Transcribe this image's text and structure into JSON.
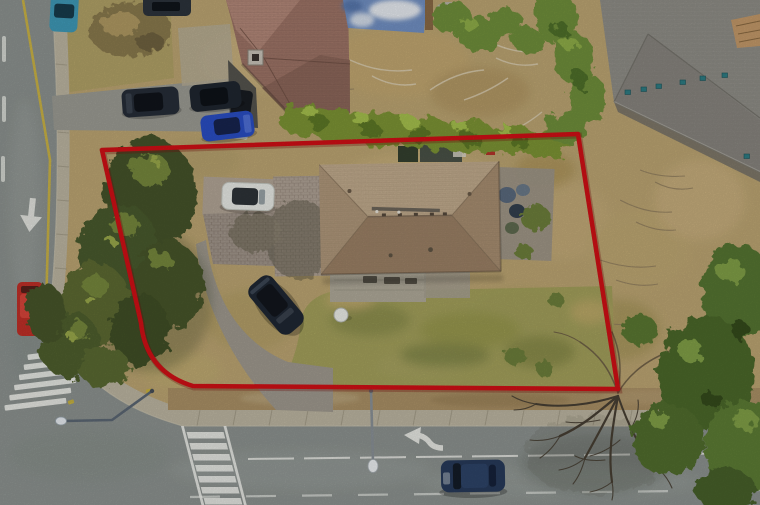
{
  "scene": {
    "title": "Top-down aerial drone photo of a corner residential lot outlined with a red property-boundary overlay",
    "view": "overhead aerial photograph",
    "boundary": {
      "color": "#d11016",
      "stroke_width": 4.5,
      "shape": "four-sided lot outline with rounded bottom-left corner",
      "corners": {
        "top_left": [
          102,
          150
        ],
        "top_right": [
          578,
          134
        ],
        "bottom_right": [
          618,
          389
        ],
        "bottom_edge_left_end": [
          193,
          386
        ],
        "left_edge_bottom_end": [
          141,
          323
        ]
      }
    },
    "colors": {
      "asphalt": "#8d9390",
      "sidewalk": "#bdb6a2",
      "verge_dirt": "#ab9166",
      "scrub_grass": "#bda673",
      "front_lawn": "#a2a05c",
      "hedge_green": "#7d9434",
      "conifer_dark": "#44532a",
      "canopy_green": "#4c682c",
      "subject_roof_light": "#c3ad8f",
      "subject_roof_dark": "#9c8166",
      "neighbor_roof": "#a07668",
      "big_roof_gray": "#92908a",
      "lane_yellow": "#d2b83e",
      "marking_white": "#f2f3ee",
      "paver_driveway": "#a79a8e"
    },
    "structures": {
      "subject_house": "large hip-roof bungalow centered in the outlined lot",
      "subject_patio": "concrete patio on south side of subject house",
      "satellite_dish": "small white dish south-west of patio",
      "neighbor_house": "clay-tile hip roof house, top left",
      "neighbor_chimney": "square chimney on neighbor roof",
      "big_gray_building": "large grey-shingled roof with teal vents, top right",
      "blue_tarp": "blue tarp with snow patches, top centre",
      "shed_items": "dark sheds / stored items behind hedge north of subject house"
    },
    "vehicles": {
      "white_car": {
        "color": "#e9ebe7",
        "location": "paver pad beside subject house"
      },
      "black_suv": {
        "color": "#1f2733",
        "location": "curved driveway of subject lot"
      },
      "neighbor_suv_1": {
        "color": "#262d38",
        "location": "neighbor driveway, left vehicle"
      },
      "neighbor_suv_2": {
        "color": "#1f2630",
        "location": "neighbor driveway, right vehicle"
      },
      "neighbor_blue_car": {
        "color": "#2a4ec4",
        "location": "neighbor driveway, lower vehicle"
      },
      "street_teal_car": {
        "color": "#3f9ab8",
        "location": "left road, top edge"
      },
      "street_dark_car_top": {
        "color": "#2c333c",
        "location": "top edge of frame"
      },
      "red_truck": {
        "color": "#c03028",
        "location": "left road, behind evergreen trees"
      },
      "road_blue_car": {
        "color": "#273a5a",
        "location": "bottom road, travelling lane"
      }
    },
    "road_markings": {
      "yellow_centre_line": "yellow line on left vertical road",
      "left_road_arrow": "white straight-ahead arrow on left road",
      "zebra_crosswalk": "zebra crosswalk across left road at intersection",
      "ladder_crosswalk": "ladder crosswalk across bottom road",
      "left_turn_arrow": "white left-turn arrow, bottom road",
      "lane_dashes": "white lane lines on bottom road"
    },
    "street_furniture": {
      "streetlight_sw": "bent streetlight arm over intersection, lamp at left",
      "streetlight_s": "streetlight pole over bottom road with white lamp"
    },
    "vegetation": {
      "evergreen_cluster": "tall evergreens along left edge of lot",
      "hedge_row": "trimmed green hedge along north boundary",
      "bare_tree": "leafless deciduous tree over bottom road at lot corner",
      "green_canopy_se": "dense green tree canopy, bottom right corner"
    }
  }
}
